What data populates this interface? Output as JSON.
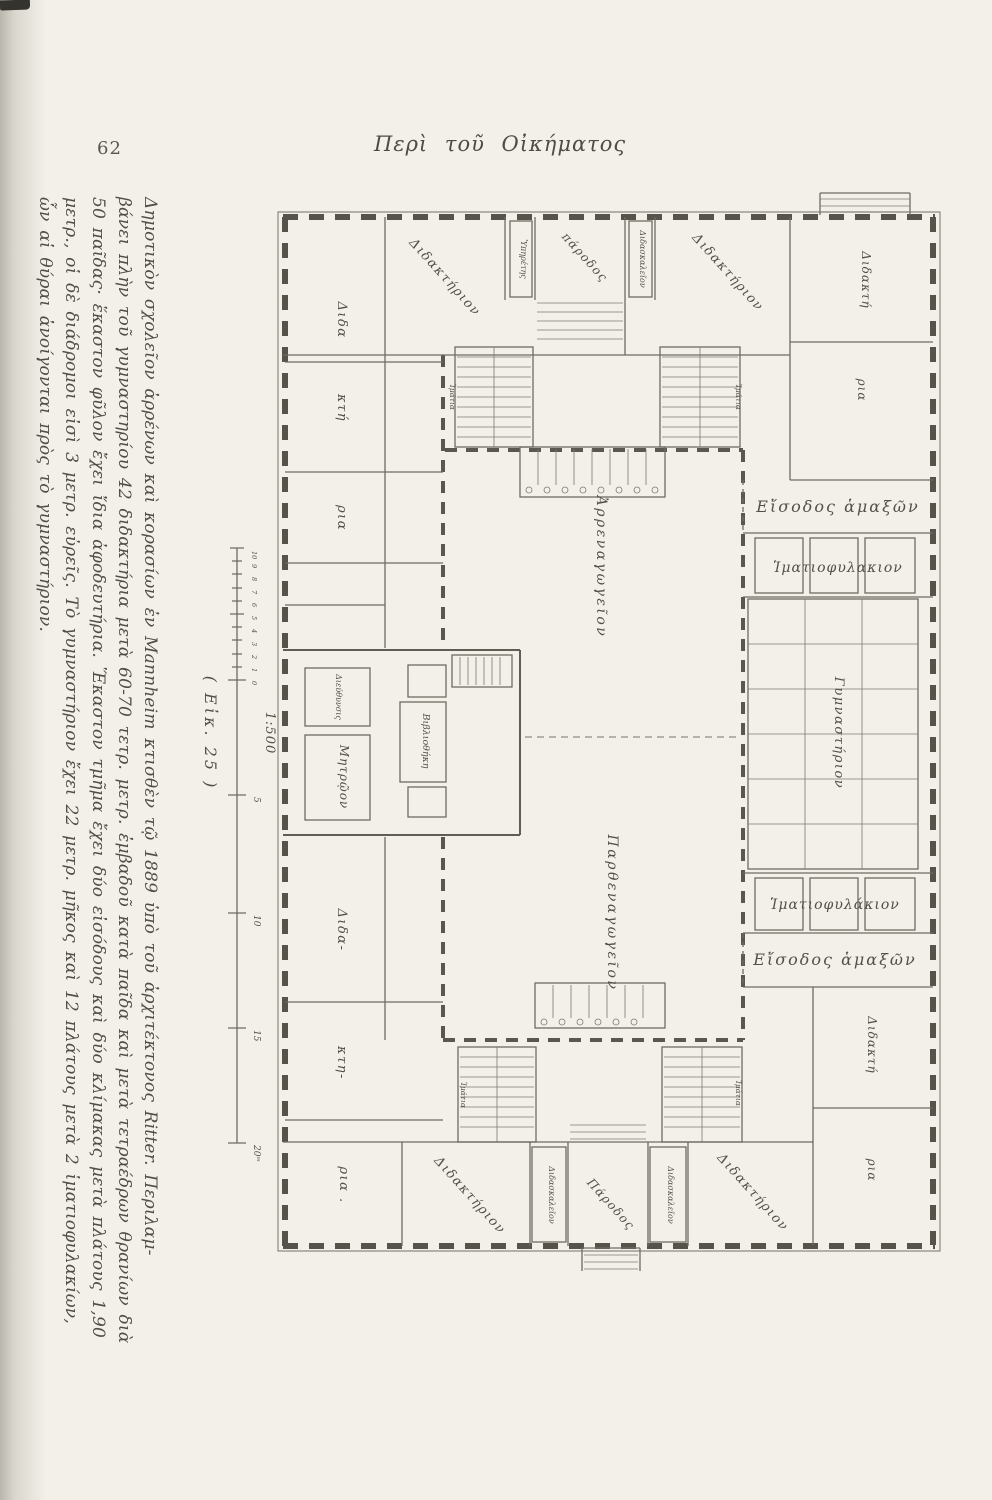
{
  "page": {
    "number": "62",
    "header": "Περὶ τοῦ Οἰκήματος"
  },
  "figure": {
    "label": "( Εἰκ. 25 )",
    "scale": {
      "ratio": "1:500",
      "minor_ticks": [
        "10",
        "9",
        "8",
        "7",
        "6",
        "5",
        "4",
        "3",
        "2",
        "1",
        "0"
      ],
      "major_ticks": [
        "5",
        "10",
        "15",
        "20ᵐ"
      ]
    }
  },
  "caption": {
    "lines": [
      "Δημοτικὸν σχολεῖον ἀρρένων καὶ κορασίων ἐν Mannheim κτισθὲν τῷ 1889 ὑπὸ τοῦ ἀρχιτέκτονος Ritter. Περιλαμ-",
      "βάνει πλὴν τοῦ γυμναστηρίου 42 διδακτήρια μετὰ 60-70 τετρ. μετρ. ἐμβαδοῦ κατὰ παῖδα καὶ μετὰ τετραέδρων θρανίων διὰ",
      "50 παῖδας· ἕκαστον φῦλον ἔχει ἴδια ἀφοδευτήρια. Ἕκαστον τμῆμα ἔχει δύο εἰσόδους καὶ δύο κλίμακας μετὰ πλάτους 1,90",
      "μετρ., οἱ δὲ διάδρομοι εἰσὶ 3 μετρ. εὐρεῖς. Τὸ γυμναστήριον ἔχει 22 μετρ. μῆκος καὶ 12 πλάτους μετὰ 2 ἱματιοφυλακίων,",
      "ὧν αἱ θύραι ἀνοίγονται πρὸς τὸ γυμναστήριον."
    ]
  },
  "plan": {
    "labels": {
      "dida": "Διδα",
      "kti": "κτή",
      "ria": "ρια",
      "dida2": "Διδα-",
      "kti2": "κτη-",
      "ria2": "ρια .",
      "didaktirion": "Διδακτήριον",
      "didakti": "Διδακτή",
      "ria3": "ρια",
      "parodos_top": "πάροδος",
      "parodos_bottom": "Πάροδος",
      "ypiretis": "Ὑπηρέτης",
      "didaskaleion": "Διδασκαλεῖον",
      "imatia": "Ἱμάτια",
      "arrenagogeion": "Ἀρρεναγωγεῖον",
      "parthenagogeion": "Παρθεναγωγεῖον",
      "gymnastirion": "Γυμναστήριον",
      "eisodos_amaxon": "Εἴσοδος ἁμαξῶν",
      "imatiofylakion_top": "Ἱματιοφυλακιον",
      "imatiofylakion_bottom": "Ἱματιοφυλάκιον",
      "diefthynsis": "Διεύθυνσις",
      "mitroon": "Μητρῷον",
      "vivliothiki": "Βιβλιοθήκη"
    }
  },
  "colors": {
    "paper": "#f2f0e9",
    "ink": "#514e45",
    "wall": "#56534b"
  }
}
